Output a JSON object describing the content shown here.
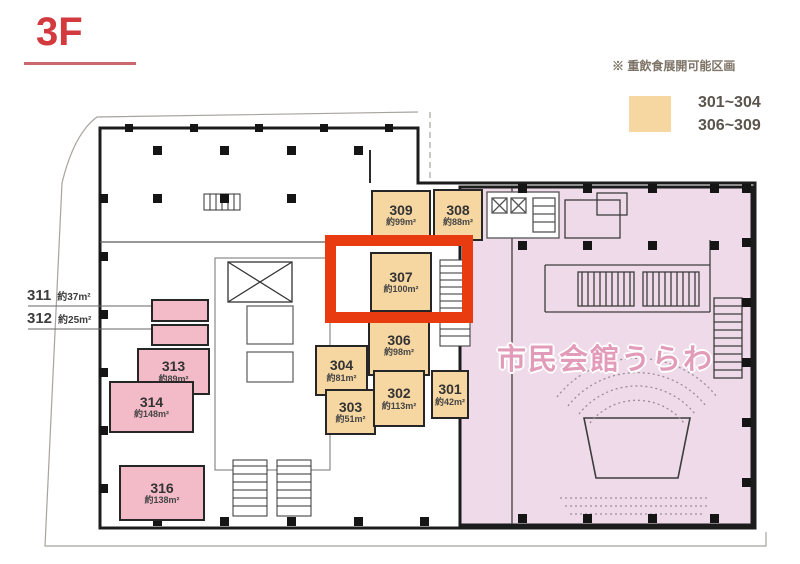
{
  "floor_label": "3F",
  "legend": {
    "note": "※ 重飲食展開可能区画",
    "range1": "301~304",
    "range2": "306~309",
    "swatch_color": "#f6d7a2"
  },
  "hall_name": "市民会館うらわ",
  "highlight": {
    "room": "307",
    "color": "#e83c10"
  },
  "rooms": [
    {
      "number": "309",
      "area": "約99m²",
      "type": "orange"
    },
    {
      "number": "308",
      "area": "約88m²",
      "type": "orange"
    },
    {
      "number": "307",
      "area": "約100m²",
      "type": "orange",
      "highlighted": true
    },
    {
      "number": "306",
      "area": "約98m²",
      "type": "orange"
    },
    {
      "number": "304",
      "area": "約81m²",
      "type": "orange"
    },
    {
      "number": "303",
      "area": "約51m²",
      "type": "orange"
    },
    {
      "number": "302",
      "area": "約113m²",
      "type": "orange"
    },
    {
      "number": "301",
      "area": "約42m²",
      "type": "orange"
    },
    {
      "number": "313",
      "area": "約89m²",
      "type": "pink"
    },
    {
      "number": "314",
      "area": "約148m²",
      "type": "pink"
    },
    {
      "number": "316",
      "area": "約138m²",
      "type": "pink"
    }
  ],
  "external_labels": [
    {
      "number": "311",
      "area": "約37m²"
    },
    {
      "number": "312",
      "area": "約25m²"
    }
  ],
  "colors": {
    "room_orange": "#f6d7a2",
    "room_pink": "#f3bac8",
    "hall_pink": "#eedae8",
    "highlight_red": "#e83c10",
    "title_red": "#d23a3e"
  }
}
